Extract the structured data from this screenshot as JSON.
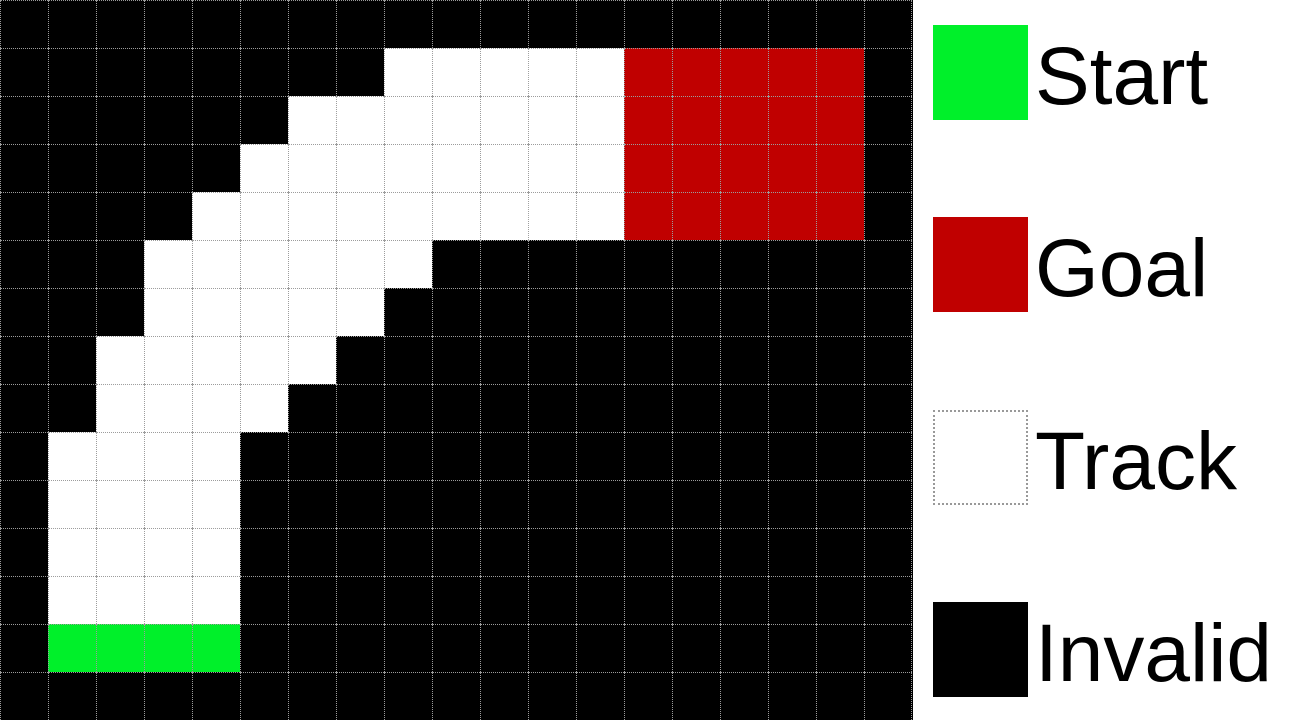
{
  "figure": {
    "title": "racetrack-grid-world",
    "grid": {
      "rows": 15,
      "cols": 19,
      "cell_size_px": 48,
      "cell_types": {
        "B": "invalid",
        "W": "track",
        "S": "start",
        "G": "goal"
      },
      "cells": [
        "BBBBBBBBBBBBBBBBBBB",
        "BBBBBBBBWWWWWGGGGGB",
        "BBBBBBWWWWWWWGGGGGB",
        "BBBBBWWWWWWWWGGGGGB",
        "BBBBWWWWWWWWWGGGGGB",
        "BBBWWWWWWBBBBBBBBBB",
        "BBBWWWWWBBBBBBBBBBB",
        "BBWWWWWBBBBBBBBBBBB",
        "BBWWWWBBBBBBBBBBBBB",
        "BWWWWBBBBBBBBBBBBBB",
        "BWWWWBBBBBBBBBBBBBB",
        "BWWWWBBBBBBBBBBBBBB",
        "BWWWWBBBBBBBBBBBBBB",
        "BSSSSBBBBBBBBBBBBBB",
        "BBBBBBBBBBBBBBBBBBB"
      ]
    },
    "colors": {
      "invalid": "#000000",
      "track": "#ffffff",
      "start": "#00f02a",
      "goal": "#c00000",
      "gridline": "#9c9c9c"
    }
  },
  "legend": {
    "items": [
      {
        "label": "Start",
        "swatch": "start"
      },
      {
        "label": "Goal",
        "swatch": "goal"
      },
      {
        "label": "Track",
        "swatch": "track"
      },
      {
        "label": "Invalid",
        "swatch": "invalid"
      }
    ]
  }
}
